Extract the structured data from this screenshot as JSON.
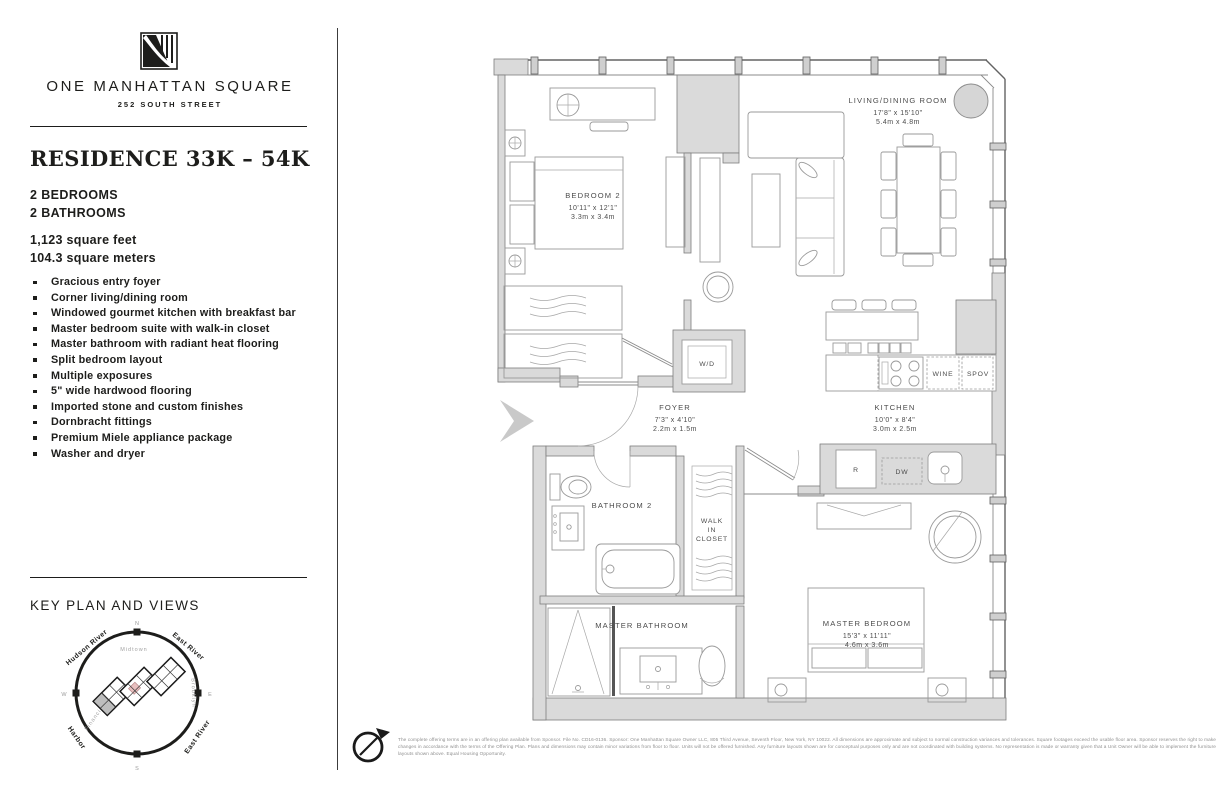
{
  "brand": {
    "name": "ONE MANHATTAN SQUARE",
    "address": "252 SOUTH STREET"
  },
  "residence": {
    "title": "RESIDENCE 33K – 54K",
    "bedrooms": "2 BEDROOMS",
    "bathrooms": "2 BATHROOMS",
    "area_ft": "1,123 square feet",
    "area_m": "104.3 square meters"
  },
  "features": [
    "Gracious entry foyer",
    "Corner living/dining room",
    "Windowed gourmet kitchen with breakfast bar",
    "Master bedroom suite with walk-in closet",
    "Master bathroom with radiant heat flooring",
    "Split bedroom layout",
    "Multiple exposures",
    "5\" wide hardwood flooring",
    "Imported stone and custom finishes",
    "Dornbracht fittings",
    "Premium Miele appliance package",
    "Washer and dryer"
  ],
  "key_plan": {
    "title": "KEY PLAN AND VIEWS",
    "compass_n": "N",
    "compass_s": "S",
    "compass_e": "E",
    "compass_w": "W",
    "label_hudson": "Hudson River",
    "label_east_river_top": "East River",
    "label_harbor": "Harbor",
    "label_east_river_bottom": "East River",
    "label_midtown": "Midtown",
    "label_brooklyn": "Brooklyn",
    "label_financial": "Financial District"
  },
  "floor_plan": {
    "bedroom2": {
      "name": "BEDROOM 2",
      "ft": "10'11\" x 12'1\"",
      "m": "3.3m x 3.4m"
    },
    "living": {
      "name": "LIVING/DINING ROOM",
      "ft": "17'8\" x 15'10\"",
      "m": "5.4m x 4.8m"
    },
    "kitchen": {
      "name": "KITCHEN",
      "ft": "10'0\" x 8'4\"",
      "m": "3.0m x 2.5m"
    },
    "foyer": {
      "name": "FOYER",
      "ft": "7'3\" x 4'10\"",
      "m": "2.2m x 1.5m"
    },
    "bathroom2": {
      "name": "BATHROOM 2"
    },
    "walk_in_closet": {
      "line1": "WALK",
      "line2": "IN",
      "line3": "CLOSET"
    },
    "master_bathroom": {
      "name": "MASTER BATHROOM"
    },
    "master_bedroom": {
      "name": "MASTER BEDROOM",
      "ft": "15'3\" x 11'11\"",
      "m": "4.6m x 3.6m"
    },
    "labels": {
      "wd": "W/D",
      "wine": "WINE",
      "spov": "SPOV",
      "fridge": "R",
      "dishwasher": "DW"
    }
  },
  "footer": {
    "disclaimer": "The complete offering terms are in an offering plan available from Sponsor. File No. CD16-0136. Sponsor: One Manhattan Square Owner LLC, 805 Third Avenue, Seventh Floor, New York, NY 10022. All dimensions are approximate and subject to normal construction variances and tolerances. Square footages exceed the usable floor area. Sponsor reserves the right to make changes in accordance with the terms of the Offering Plan. Plans and dimensions may contain minor variations from floor to floor. Units will not be offered furnished. Any furniture layouts shown are for conceptual purposes only and are not coordinated with building systems. No representation is made or warranty given that a Unit Owner will be able to implement the furniture layouts shown above. Equal Housing Opportunity."
  },
  "colors": {
    "ink": "#1d1d1b",
    "wall_fill": "#dadada",
    "plan_text": "#4c4c4c"
  }
}
